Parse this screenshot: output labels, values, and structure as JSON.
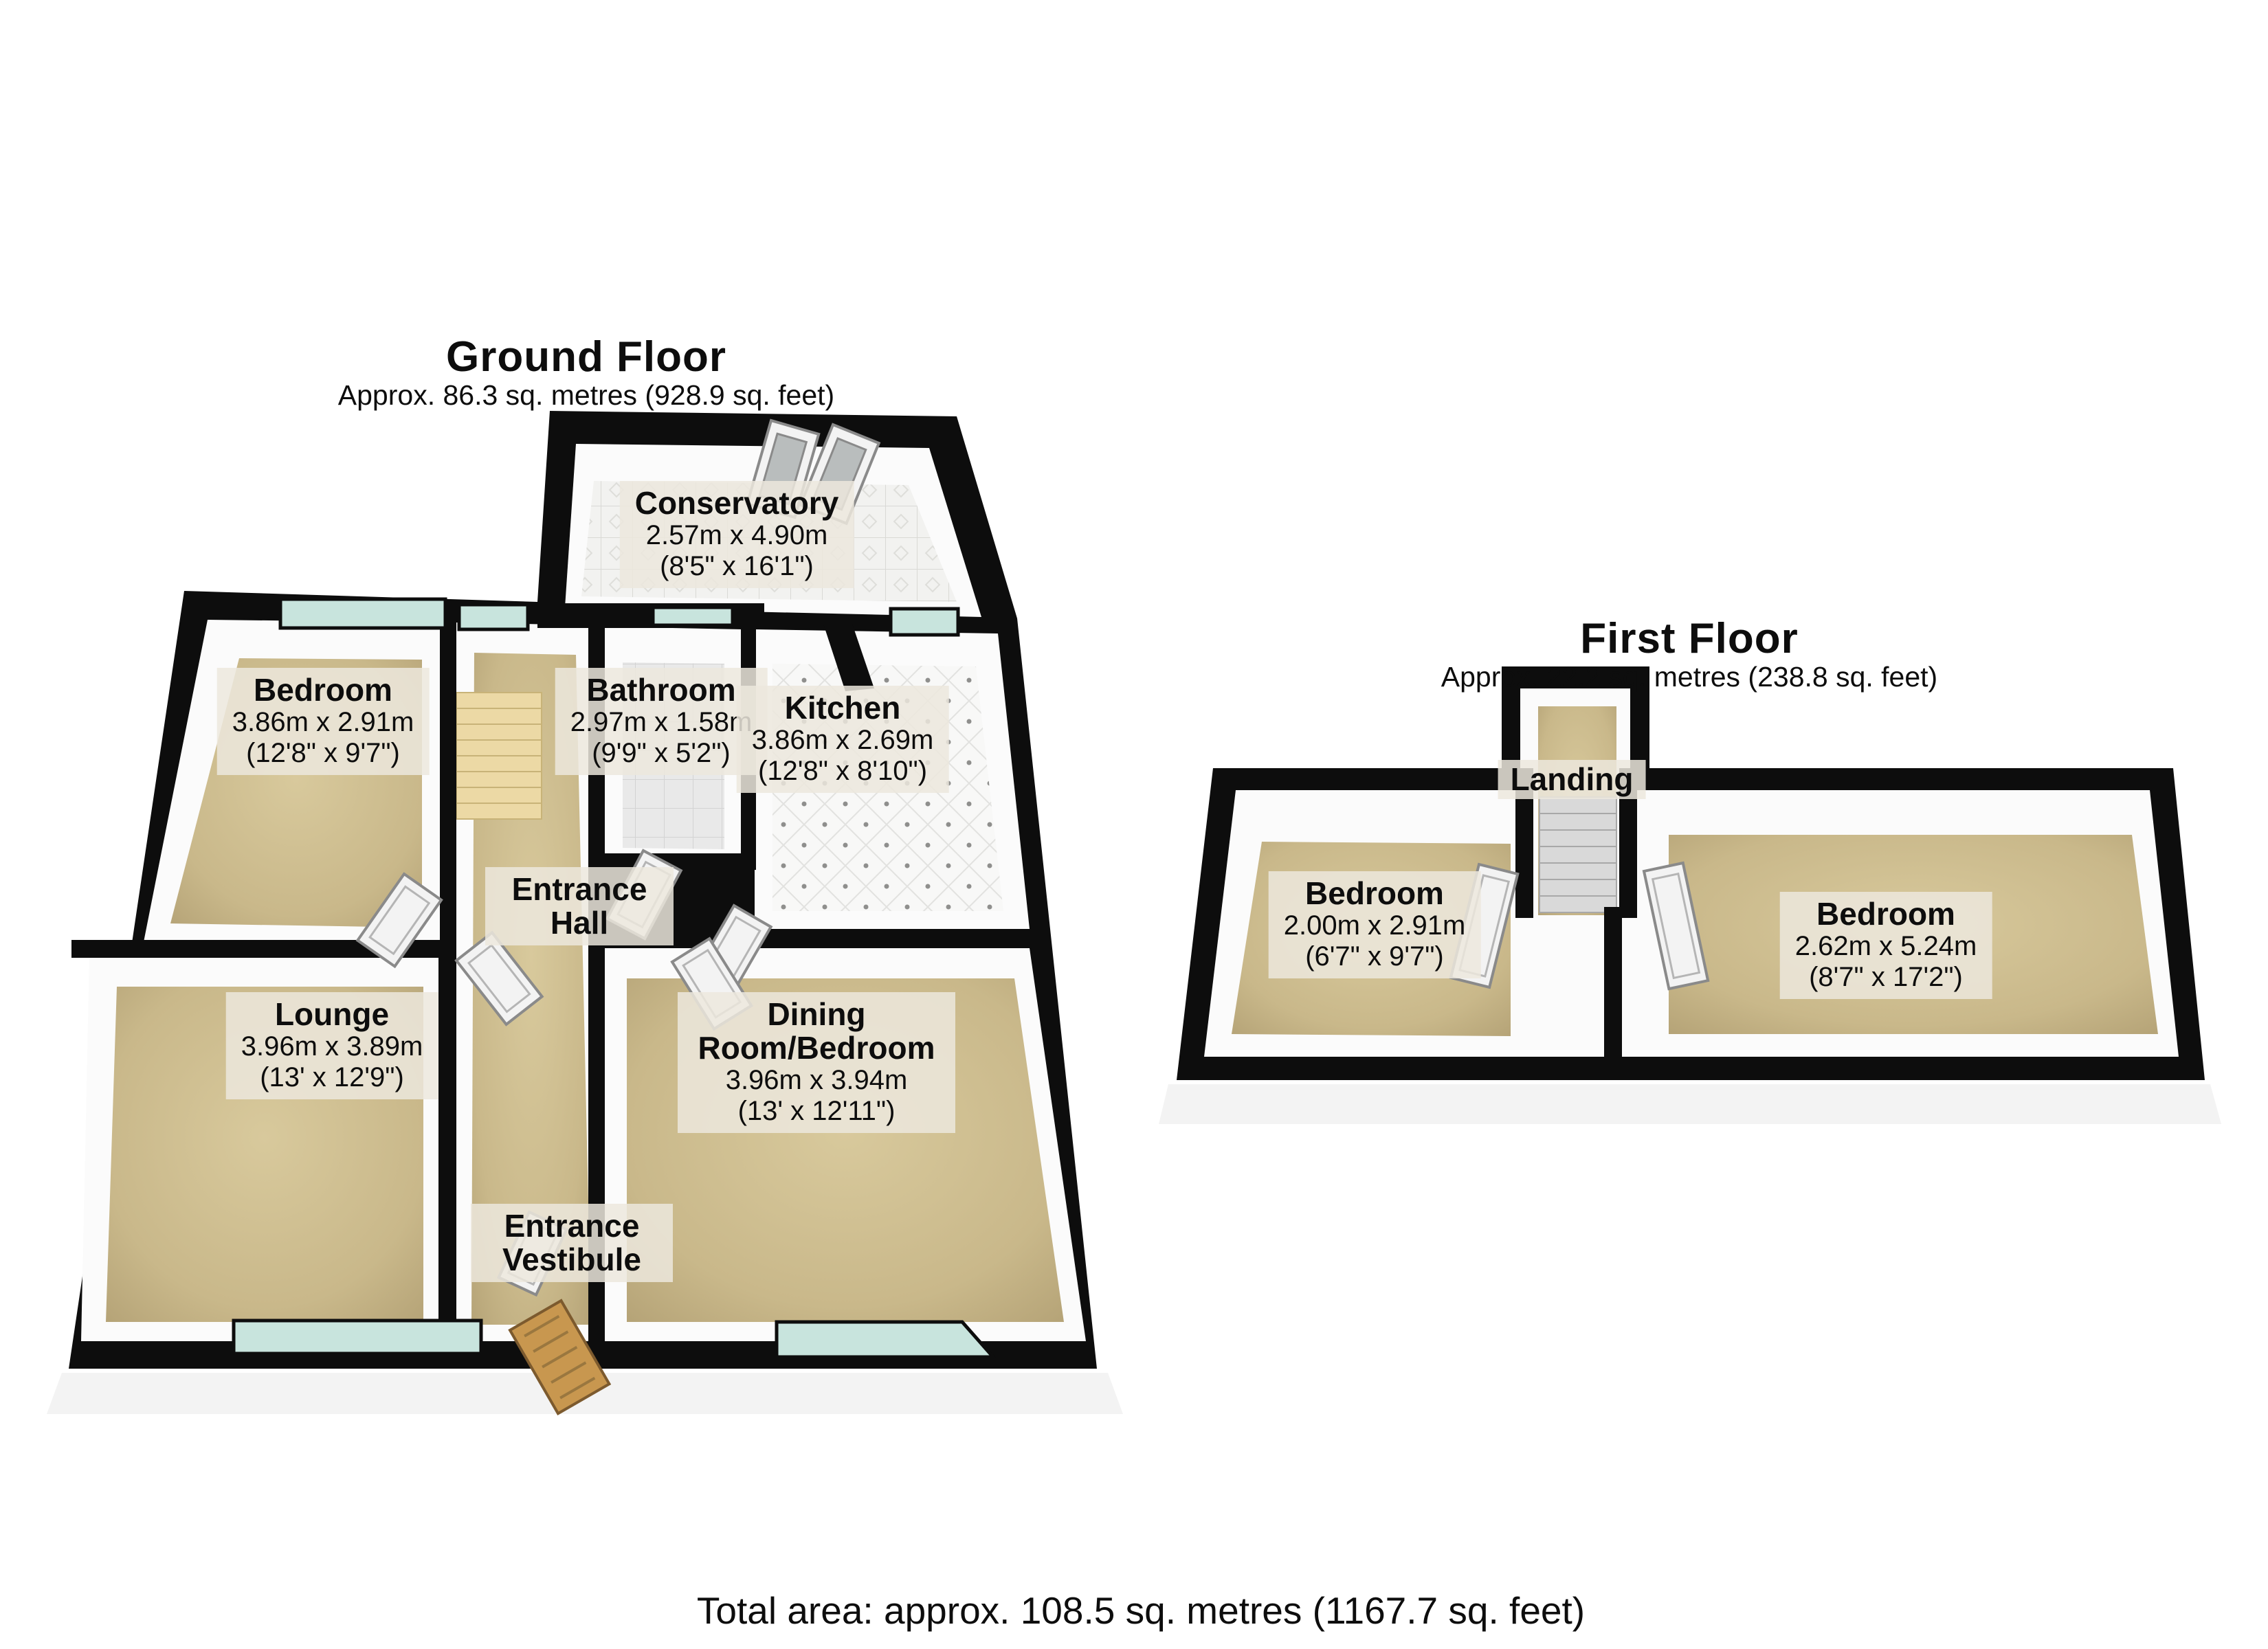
{
  "ground_floor": {
    "title": "Ground Floor",
    "subtitle": "Approx. 86.3 sq. metres (928.9 sq. feet)",
    "rooms": [
      {
        "name": "Conservatory",
        "dims_m": "2.57m x 4.90m",
        "dims_ft": "(8'5\" x 16'1\")"
      },
      {
        "name": "Bedroom",
        "dims_m": "3.86m x 2.91m",
        "dims_ft": "(12'8\" x 9'7\")"
      },
      {
        "name": "Bathroom",
        "dims_m": "2.97m x 1.58m",
        "dims_ft": "(9'9\" x 5'2\")"
      },
      {
        "name": "Kitchen",
        "dims_m": "3.86m x 2.69m",
        "dims_ft": "(12'8\" x 8'10\")"
      },
      {
        "name": "Entrance Hall"
      },
      {
        "name": "Lounge",
        "dims_m": "3.96m x 3.89m",
        "dims_ft": "(13' x 12'9\")"
      },
      {
        "name": "Dining Room/Bedroom",
        "dims_m": "3.96m x 3.94m",
        "dims_ft": "(13' x 12'11\")"
      },
      {
        "name": "Entrance Vestibule"
      }
    ]
  },
  "first_floor": {
    "title": "First Floor",
    "subtitle": "Approx. 22.2 sq. metres (238.8 sq. feet)",
    "rooms": [
      {
        "name": "Landing"
      },
      {
        "name": "Bedroom",
        "dims_m": "2.00m x 2.91m",
        "dims_ft": "(6'7\" x 9'7\")"
      },
      {
        "name": "Bedroom",
        "dims_m": "2.62m x 5.24m",
        "dims_ft": "(8'7\" x 17'2\")"
      }
    ]
  },
  "footer": {
    "total_area": "Total area: approx. 108.5 sq. metres (1167.7 sq. feet)"
  },
  "colors": {
    "wall": "#0d0d0d",
    "floor_tan": "#c9b88a",
    "stair_tan": "#ecd9a5",
    "window_glass": "#c8e4dd",
    "tile_light": "#f2f2f0",
    "label_background": "#ece8dd",
    "front_door_wood": "#c8974f",
    "page_background": "#ffffff"
  }
}
